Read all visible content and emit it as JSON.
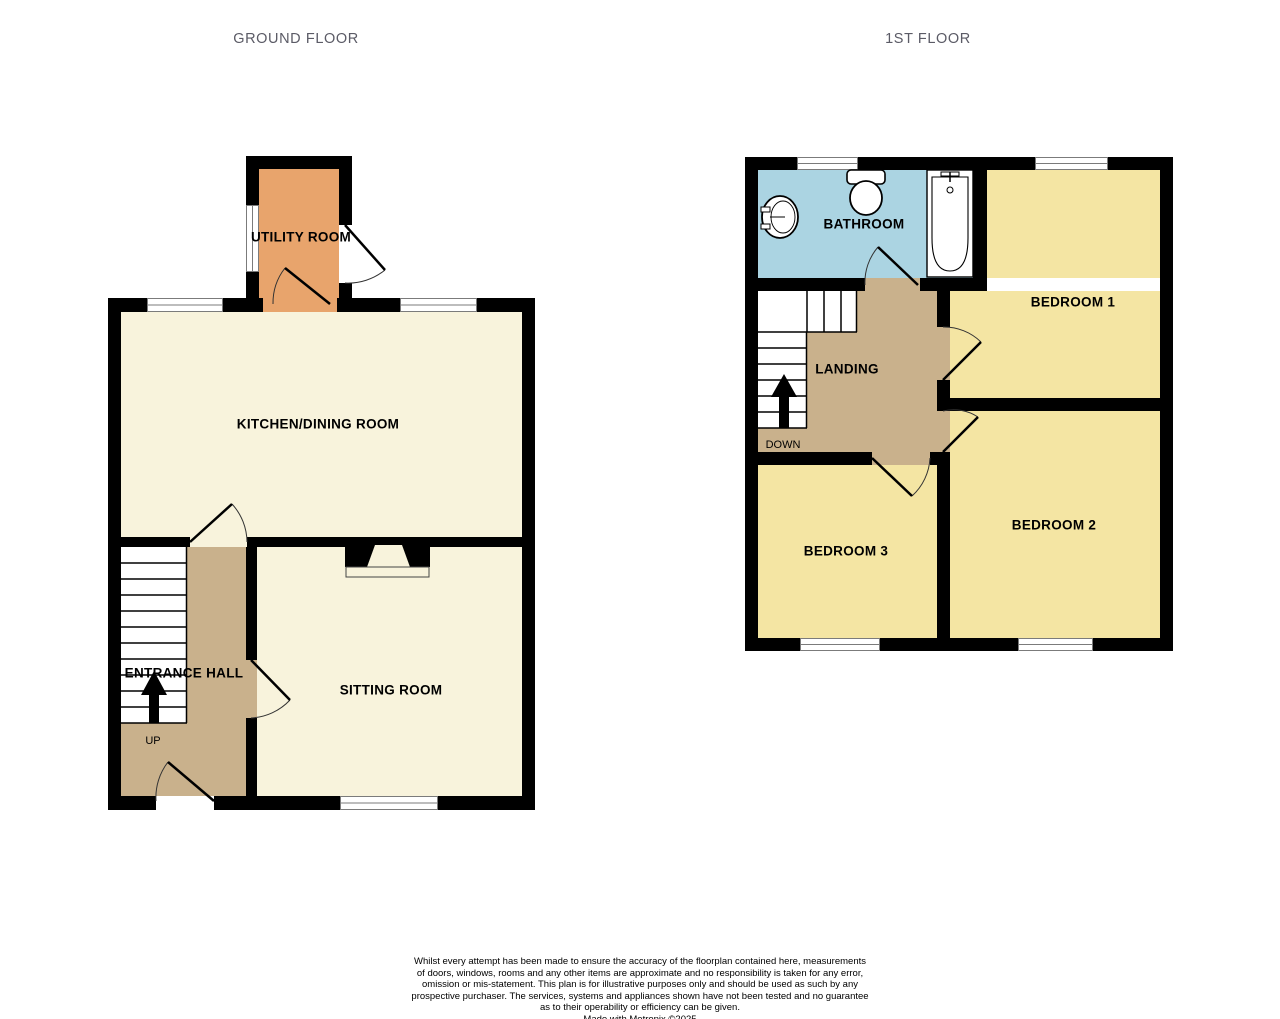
{
  "titles": {
    "ground_floor": "GROUND FLOOR",
    "first_floor": "1ST FLOOR"
  },
  "ground_floor": {
    "rooms": {
      "utility": "UTILITY ROOM",
      "kitchen": "KITCHEN/DINING ROOM",
      "entrance_hall": "ENTRANCE HALL",
      "sitting": "SITTING ROOM"
    },
    "stairs_direction_label": "UP"
  },
  "first_floor": {
    "rooms": {
      "bathroom": "BATHROOM",
      "bedroom1": "BEDROOM 1",
      "landing": "LANDING",
      "bedroom2": "BEDROOM 2",
      "bedroom3": "BEDROOM 3"
    },
    "stairs_direction_label": "DOWN"
  },
  "disclaimer": {
    "lines": [
      "Whilst every attempt has been made to ensure the accuracy of the floorplan contained here, measurements",
      "of doors, windows, rooms and any other items are approximate and no responsibility is taken for any error,",
      "omission or mis-statement. This plan is for illustrative purposes only and should be used as such by any",
      "prospective purchaser. The services, systems and appliances shown have not been tested and no guarantee",
      "as to their operability or efficiency can be given."
    ],
    "made_with": "Made with Metropix ©2025"
  },
  "colors": {
    "wall": "#000000",
    "pale_room_fill": "#f8f3dc",
    "bedroom_fill": "#f4e5a3",
    "hall_landing_fill": "#c9b18c",
    "utility_fill": "#e8a46c",
    "bathroom_fill": "#abd4e2",
    "window_line": "#7b7b7b",
    "title_text": "#5b5b66"
  }
}
